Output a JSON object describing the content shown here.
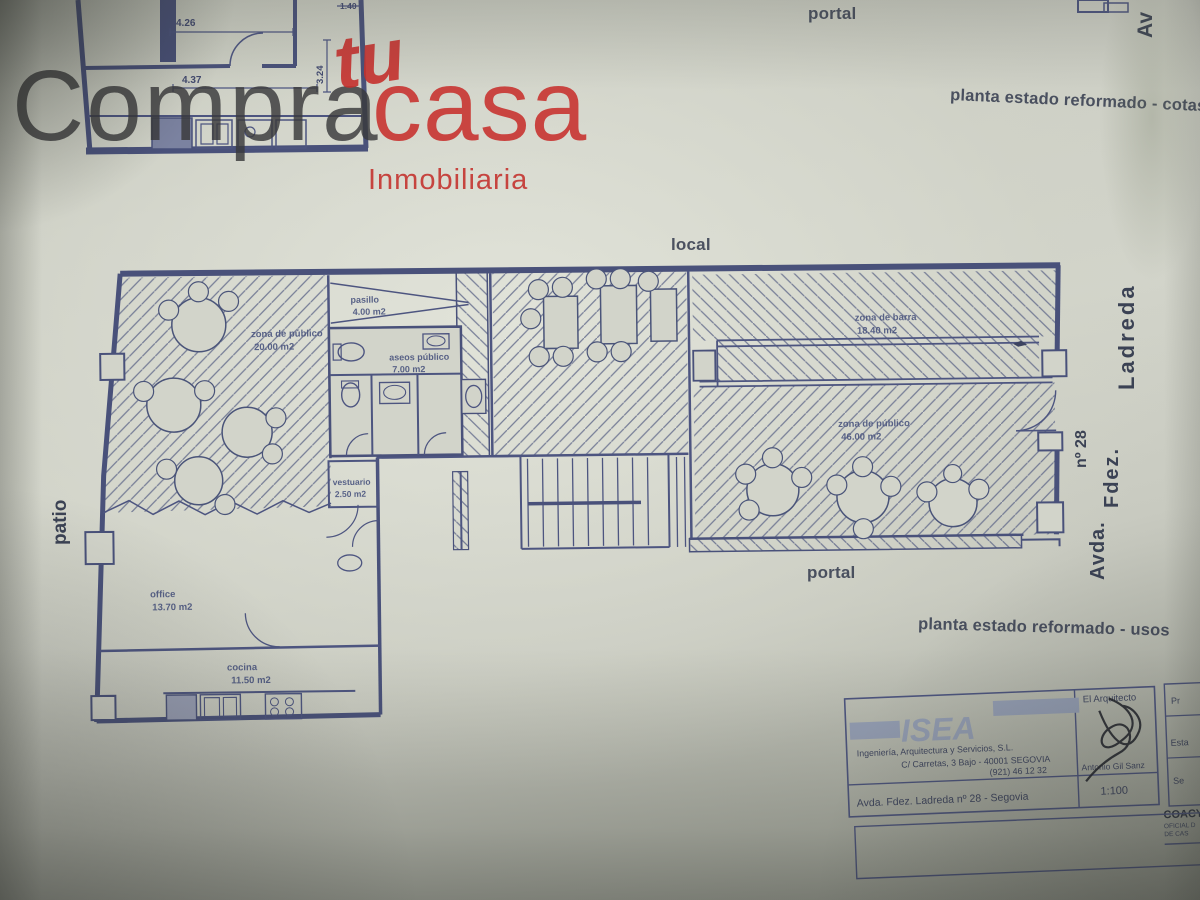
{
  "logo": {
    "word1": "Compra",
    "word2": "tu",
    "word3": "casa",
    "subtitle": "Inmobiliaria"
  },
  "labels": {
    "portal_top": "portal",
    "av_top": "Av",
    "plan_title_cotas": "planta estado reformado - cotas",
    "local": "local",
    "patio": "patio",
    "portal_bottom": "portal",
    "plan_title_usos": "planta estado reformado - usos",
    "street_avda": "Avda.",
    "street_fdez": "Fdez.",
    "street_ladreda": "Ladreda",
    "street_num": "nº 28"
  },
  "top_plan_dims": {
    "d1": "4.26",
    "d2": "4.37",
    "d3": "3.24",
    "d4": "1.40"
  },
  "rooms": [
    {
      "name": "zona de público",
      "area": "20.00 m2"
    },
    {
      "name": "pasillo",
      "area": "4.00 m2"
    },
    {
      "name": "aseos público",
      "area": "7.00 m2"
    },
    {
      "name": "vestuario",
      "area": "2.50 m2"
    },
    {
      "name": "office",
      "area": "13.70 m2"
    },
    {
      "name": "cocina",
      "area": "11.50 m2"
    },
    {
      "name": "zona de barra",
      "area": "18.40 m2"
    },
    {
      "name": "zona de público",
      "area": "46.00 m2"
    }
  ],
  "titleblock": {
    "firm": "ISEA",
    "firm_tagline": "Ingeniería, Arquitectura y Servicios, S.L.",
    "address1": "C/ Carretas, 3 Bajo - 40001 SEGOVIA",
    "address2": "(921) 46 12 32",
    "architect_label": "El Arquitecto",
    "architect_name": "Antonio Gil Sanz",
    "project_address": "Avda. Fdez. Ladreda nº 28 - Segovia",
    "scale": "1:100",
    "side_label1": "Pr",
    "side_label2": "Esta",
    "side_label3": "Se",
    "stamp_line1": "COACY",
    "stamp_line2": "OFICIAL D",
    "stamp_line3": "DE CAS"
  },
  "colors": {
    "paper": "#d2d4ca",
    "ink_blue": "#49517a",
    "label_dark": "#3b4254",
    "brand_red": "#c8302d",
    "logo_dark": "#3a3a3c",
    "isea_gray": "#96a0b6"
  }
}
